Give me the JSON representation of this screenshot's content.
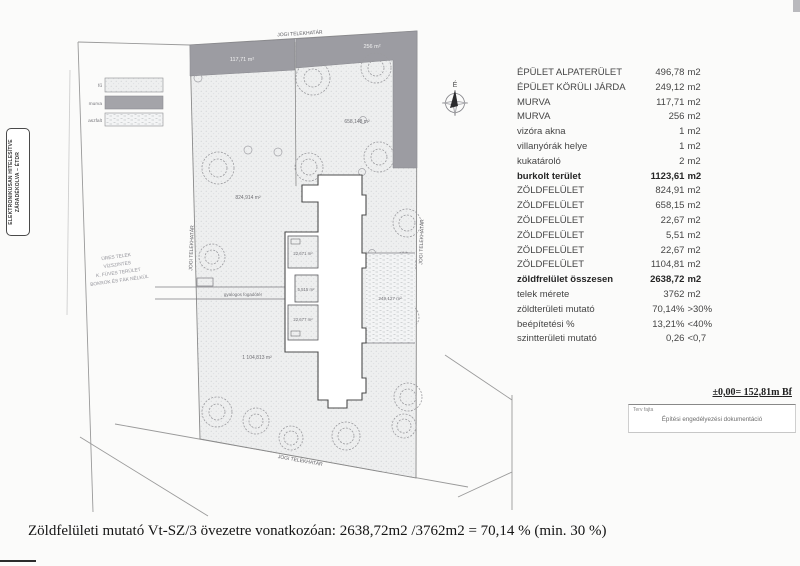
{
  "stamp": {
    "line1": "ELEKTRONIKUSAN HITELESÍTVE",
    "line2": "ZÁRADÉKOLVA – ÉTDR"
  },
  "legend": {
    "grass": "fű",
    "gravel": "murva",
    "asphalt": "aszfalt"
  },
  "plan": {
    "boundary_top": "JOGI TELEKHATÁR",
    "boundary_left": "JOGI TELEKHATÁR",
    "boundary_right": "JOGI TELEKHATÁR",
    "boundary_bottom": "JOGI TELEKHATÁR",
    "compass": "É",
    "path_label": "gyalogos fogadótér",
    "note": {
      "l1": "ÜRES TELEK",
      "l2": "VÍZSZINTES",
      "l3": "K. FÜVES TERÜLET",
      "l4": "BOKROK ÉS FÁK NÉLKÜL"
    },
    "areas": {
      "murva_left": "117,71 m²",
      "murva_right": "256 m²",
      "green_ne": "658,148 m²",
      "green_w": "824,914 m²",
      "green_s": "1 104,813 m²",
      "court_upper": "22,671 m²",
      "court_mid": "5,515 m²",
      "court_lower": "22,677 m²",
      "walk_right": "249,127 m²"
    }
  },
  "table": {
    "rows": [
      {
        "label": "ÉPÜLET ALPATERÜLET",
        "value": "496,78",
        "unit": "m2"
      },
      {
        "label": "ÉPÜLET KÖRÜLI JÁRDA",
        "value": "249,12",
        "unit": "m2"
      },
      {
        "label": "MURVA",
        "value": "117,71",
        "unit": "m2"
      },
      {
        "label": "MURVA",
        "value": "256",
        "unit": "m2"
      },
      {
        "label": "vizóra akna",
        "value": "1",
        "unit": "m2"
      },
      {
        "label": "villanyórák helye",
        "value": "1",
        "unit": "m2"
      },
      {
        "label": "kukatároló",
        "value": "2",
        "unit": "m2"
      },
      {
        "label": "burkolt terület",
        "value": "1123,61",
        "unit": "m2"
      },
      {
        "label": "ZÖLDFELÜLET",
        "value": "824,91",
        "unit": "m2"
      },
      {
        "label": "ZÖLDFELÜLET",
        "value": "658,15",
        "unit": "m2"
      },
      {
        "label": "ZÖLDFELÜLET",
        "value": "22,67",
        "unit": "m2"
      },
      {
        "label": "ZÖLDFELÜLET",
        "value": "5,51",
        "unit": "m2"
      },
      {
        "label": "ZÖLDFELÜLET",
        "value": "22,67",
        "unit": "m2"
      },
      {
        "label": "ZÖLDFELÜLET",
        "value": "1104,81",
        "unit": "m2"
      },
      {
        "label": "zöldfrelület összesen",
        "value": "2638,72",
        "unit": "m2"
      },
      {
        "label": "telek mérete",
        "value": "3762",
        "unit": "m2"
      },
      {
        "label": "zöldterületi mutató",
        "value": "70,14%",
        "unit": ">30%"
      },
      {
        "label": "beépítetési %",
        "value": "13,21%",
        "unit": "<40%"
      },
      {
        "label": "szintterületi mutató",
        "value": "0,26",
        "unit": "<0,7"
      }
    ]
  },
  "elevation": "±0,00= 152,81m Bf",
  "title_block": {
    "label": "Terv fajta",
    "value": "Építési engedélyezési dokumentáció"
  },
  "footer": "Zöldfelületi mutató Vt-SZ/3 övezetre vonatkozóan: 2638,72m2 /3762m2 = 70,14 % (min. 30 %)"
}
